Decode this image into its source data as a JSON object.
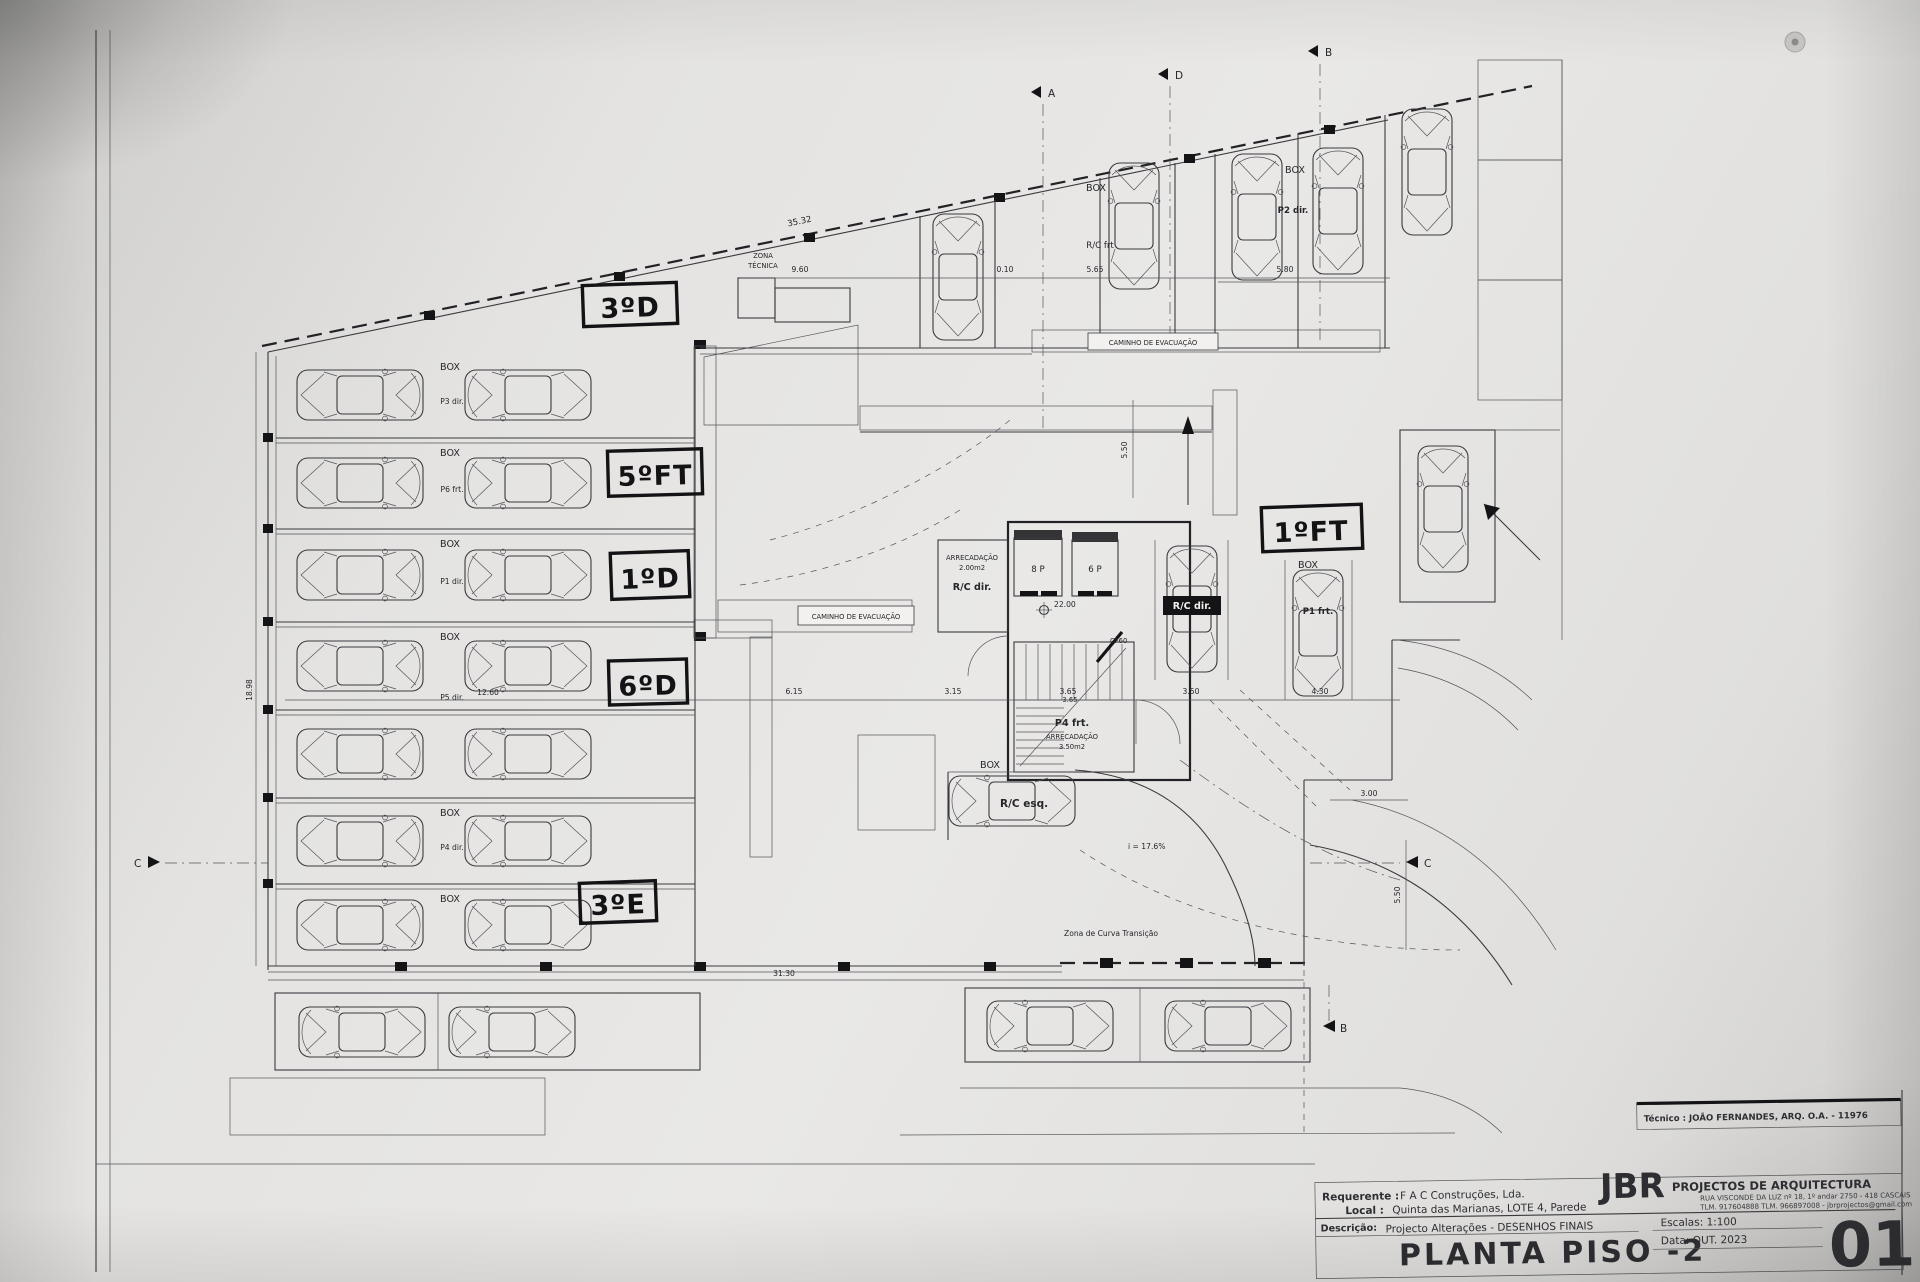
{
  "title_block": {
    "firm_initials": "JBR",
    "firm_name": "PROJECTOS DE ARQUITECTURA",
    "firm_address": "RUA VISCONDE DA LUZ nº 18, 1º andar  2750 - 418  CASCAIS",
    "firm_contacts": "TLM. 917604888  TLM. 966897008  -  jbrprojectos@gmail.com",
    "tecnico": "Técnico : JOÃO FERNANDES, ARQ.   O.A. - 11976",
    "requerente_label": "Requerente :",
    "requerente_value": "F A C  Construções, Lda.",
    "local_label": "Local :",
    "local_value": "Quinta das Marianas, LOTE 4, Parede",
    "descricao_label": "Descrição:",
    "descricao_value": "Projecto Alterações - DESENHOS FINAIS",
    "drawing_title": "PLANTA PISO -2",
    "escalas": "Escalas:  1:100",
    "data": "Data: OUT.  2023",
    "sheet_number": "01"
  },
  "handwritten": {
    "apt_3d": "3ºD",
    "apt_5ft": "5ºFT",
    "apt_1d": "1ºD",
    "apt_6d": "6ºD",
    "apt_3e": "3ºE",
    "apt_1ft": "1ºFT"
  },
  "plan": {
    "labels": {
      "zona_tecnica_1": "ZONA",
      "zona_tecnica_2": "TÉCNICA",
      "caminho_top": "CAMINHO DE EVACUAÇÃO",
      "caminho_mid": "CAMINHO DE EVACUAÇÃO",
      "curva": "Zona de Curva Transição",
      "slope": "i = 17.6%",
      "level": "22.00",
      "cf60": "CF60",
      "store1_name": "ARRECADAÇÃO",
      "store1_area": "2.00m2",
      "store1_unit": "R/C dir.",
      "lift1": "8 P",
      "lift2": "6 P",
      "stair_unit": "P4 frt.",
      "store2_name": "ARRECADAÇÃO",
      "store2_area": "3.50m2",
      "box_rc_esq": "BOX",
      "rc_esq": "R/C esq.",
      "rc_dir_stall": "R/C dir.",
      "box_top": "BOX",
      "rc_frt": "R/C frt",
      "box_p2": "BOX",
      "p2_dir": "P2 dir.",
      "box_p1": "BOX",
      "p1_frt": "P1 frt."
    },
    "stalls": [
      {
        "box": "BOX",
        "label": "P3 dir."
      },
      {
        "box": "BOX",
        "label": "P6 frt."
      },
      {
        "box": "BOX",
        "label": "P1 dir."
      },
      {
        "box": "BOX",
        "label": "P5 dir."
      },
      {
        "box": "",
        "label": ""
      },
      {
        "box": "BOX",
        "label": "P4 dir."
      },
      {
        "box": "BOX",
        "label": ""
      }
    ],
    "dims": {
      "slant": "35.32",
      "top": [
        "9.60",
        "0.10",
        "5.65",
        "5.80"
      ],
      "left": "18.98",
      "block": "12.60",
      "mid": [
        "6.15",
        "3.15",
        "3.65",
        "3.50",
        "4.30"
      ],
      "bottom": "31.30",
      "right_w": "3.00",
      "right_h": "5.50",
      "core_h": "5.50",
      "stair": "3.65"
    },
    "sections": {
      "top_a": "A",
      "top_d": "D",
      "top_b": "B",
      "left_c": "C",
      "right_c": "C",
      "bottom_b": "B"
    }
  }
}
